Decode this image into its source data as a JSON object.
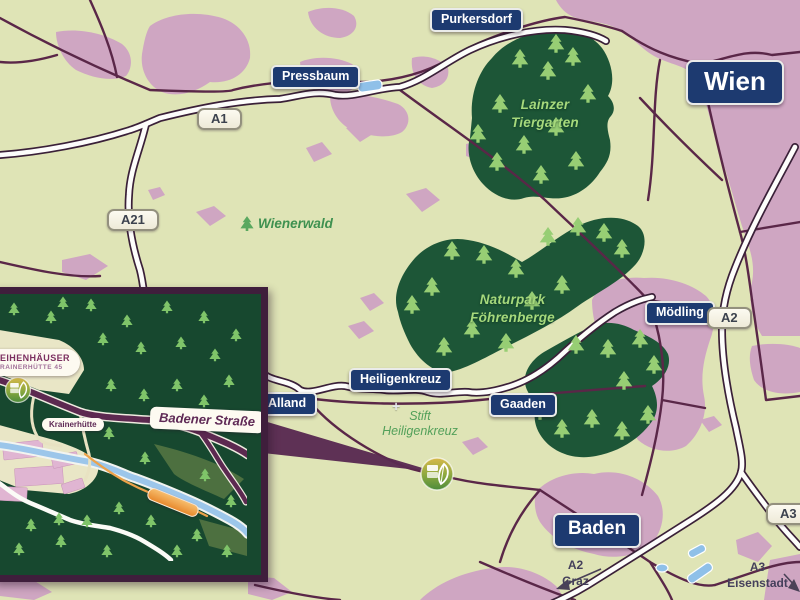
{
  "map_title": "Wienerwald region road map with Krainerhütte inset",
  "city_labels": {
    "purkersdorf": "Purkersdorf",
    "pressbaum": "Pressbaum",
    "wien": "Wien",
    "moedling": "Mödling",
    "heiligenkreuz": "Heiligenkreuz",
    "alland": "Alland",
    "gaaden": "Gaaden",
    "baden": "Baden"
  },
  "road_shields": {
    "a1": "A1",
    "a21": "A21",
    "a2": "A2",
    "a3": "A3"
  },
  "forest_labels": {
    "lainzer_line1": "Lainzer",
    "lainzer_line2": "Tiergarten",
    "naturpark_line1": "Naturpark",
    "naturpark_line2": "Föhrenberge",
    "wienerwald": "Wienerwald"
  },
  "poi_labels": {
    "stift_line1": "Stift",
    "stift_line2": "Heiligenkreuz",
    "cross_glyph": "+"
  },
  "direction_labels": {
    "a2_dest_line1": "A2",
    "a2_dest_line2": "Graz",
    "a3_dest_line1": "A3",
    "a3_dest_line2": "Eisenstadt"
  },
  "inset": {
    "callout_line1": "EIHENHÄUSER",
    "callout_line2": "RAINERHÜTTE 45",
    "station_label": "Krainerhütte",
    "street_label": "Badener Straße"
  },
  "icons": {
    "marker": "eco-resort-marker-icon",
    "tree": "conifer-tree-icon",
    "cross": "monastery-cross-icon",
    "trail_badge": "trail-badge"
  },
  "colors": {
    "label_navy": "#1d3a70",
    "shield_bg": "#faf7ec",
    "forest_green": "#1d5637",
    "tree_green": "#97ce74",
    "inset_tree_green": "#7fc469",
    "urban_pink": "#cfa6c2",
    "base_beige": "#dfe4b6",
    "road_purple": "#5a2748",
    "highway_casing": "#3a2038",
    "highway_white": "#fdfdfb",
    "water_blue": "#8fc0e8",
    "marker_gold": "#d8b94a",
    "marker_green": "#4c8b3c",
    "trail_orange": "#e88a2e",
    "inset_border": "#3f1e3c"
  }
}
